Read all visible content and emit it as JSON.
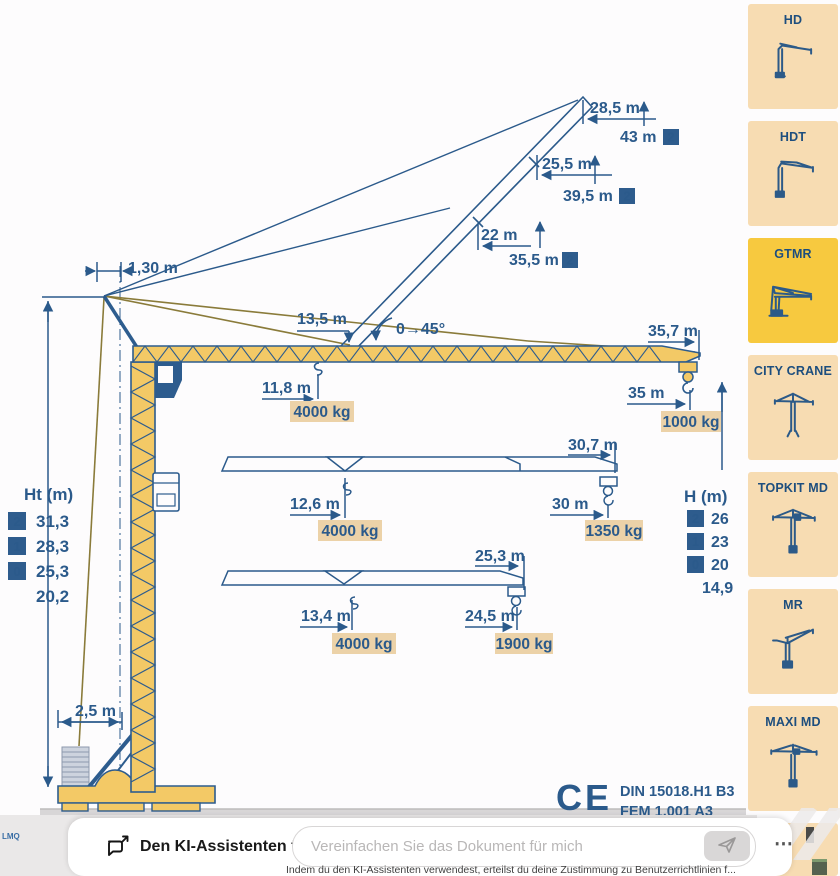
{
  "diagram": {
    "side_label": "LMQ",
    "apex_offset": "1,30 m",
    "slew_angle": "0→45°",
    "base_width": "2,5 m",
    "ce_mark": "CE",
    "standards": [
      "DIN 15018.H1 B3",
      "FEM 1.001 A3"
    ],
    "top_dims": [
      {
        "radius": "28,5 m",
        "height": "43 m",
        "badge": "2"
      },
      {
        "radius": "25,5 m",
        "height": "39,5 m",
        "badge": "2"
      },
      {
        "radius": "22 m",
        "height": "35,5 m",
        "badge": "2"
      }
    ],
    "ht_table": {
      "title": "Ht (m)",
      "rows": [
        {
          "badge": "2",
          "value": "31,3"
        },
        {
          "badge": "1",
          "value": "28,3"
        },
        {
          "badge": "0",
          "value": "25,3"
        },
        {
          "badge": "",
          "value": "20,2"
        }
      ]
    },
    "h_table": {
      "title": "H (m)",
      "rows": [
        {
          "badge": "2",
          "value": "26"
        },
        {
          "badge": "1",
          "value": "23"
        },
        {
          "badge": "0",
          "value": "20"
        },
        {
          "badge": "",
          "value": "14,9"
        }
      ]
    },
    "jib45": {
      "root_radius": "13,5 m",
      "tip_radius": "35,7 m",
      "trolley_radius": "11,8 m",
      "trolley_load": "4000 kg",
      "hook_radius": "35 m",
      "hook_load": "1000 kg"
    },
    "jib30": {
      "tip_radius": "30,7 m",
      "trolley_radius": "12,6 m",
      "trolley_load": "4000 kg",
      "hook_radius": "30 m",
      "hook_load": "1350 kg"
    },
    "jib25": {
      "tip_radius": "25,3 m",
      "trolley_radius": "13,4 m",
      "trolley_load": "4000 kg",
      "hook_radius": "24,5 m",
      "hook_load": "1900 kg"
    }
  },
  "sidebar": {
    "items": [
      {
        "label": "HD",
        "selected": false
      },
      {
        "label": "HDT",
        "selected": false
      },
      {
        "label": "GTMR",
        "selected": true
      },
      {
        "label": "CITY CRANE",
        "selected": false
      },
      {
        "label": "TOPKIT MD",
        "selected": false
      },
      {
        "label": "MR",
        "selected": false
      },
      {
        "label": "MAXI MD",
        "selected": false
      }
    ]
  },
  "assistant_bar": {
    "title": "Den KI-Assistenten fragen",
    "input_placeholder": "Vereinfachen Sie das Dokument für mich",
    "more_label": "⋯",
    "disclaimer": "Indem du den KI-Assistenten verwendest, erteilst du deine Zustimmung zu Benutzerrichtlinien f..."
  },
  "colors": {
    "navy": "#2b5a8b",
    "crane_yellow": "#f3c966",
    "load_tag": "#ecd2a8",
    "card_peach": "#f7dcb2",
    "card_selected": "#f7c93f",
    "ground": "#d8d6d7"
  }
}
